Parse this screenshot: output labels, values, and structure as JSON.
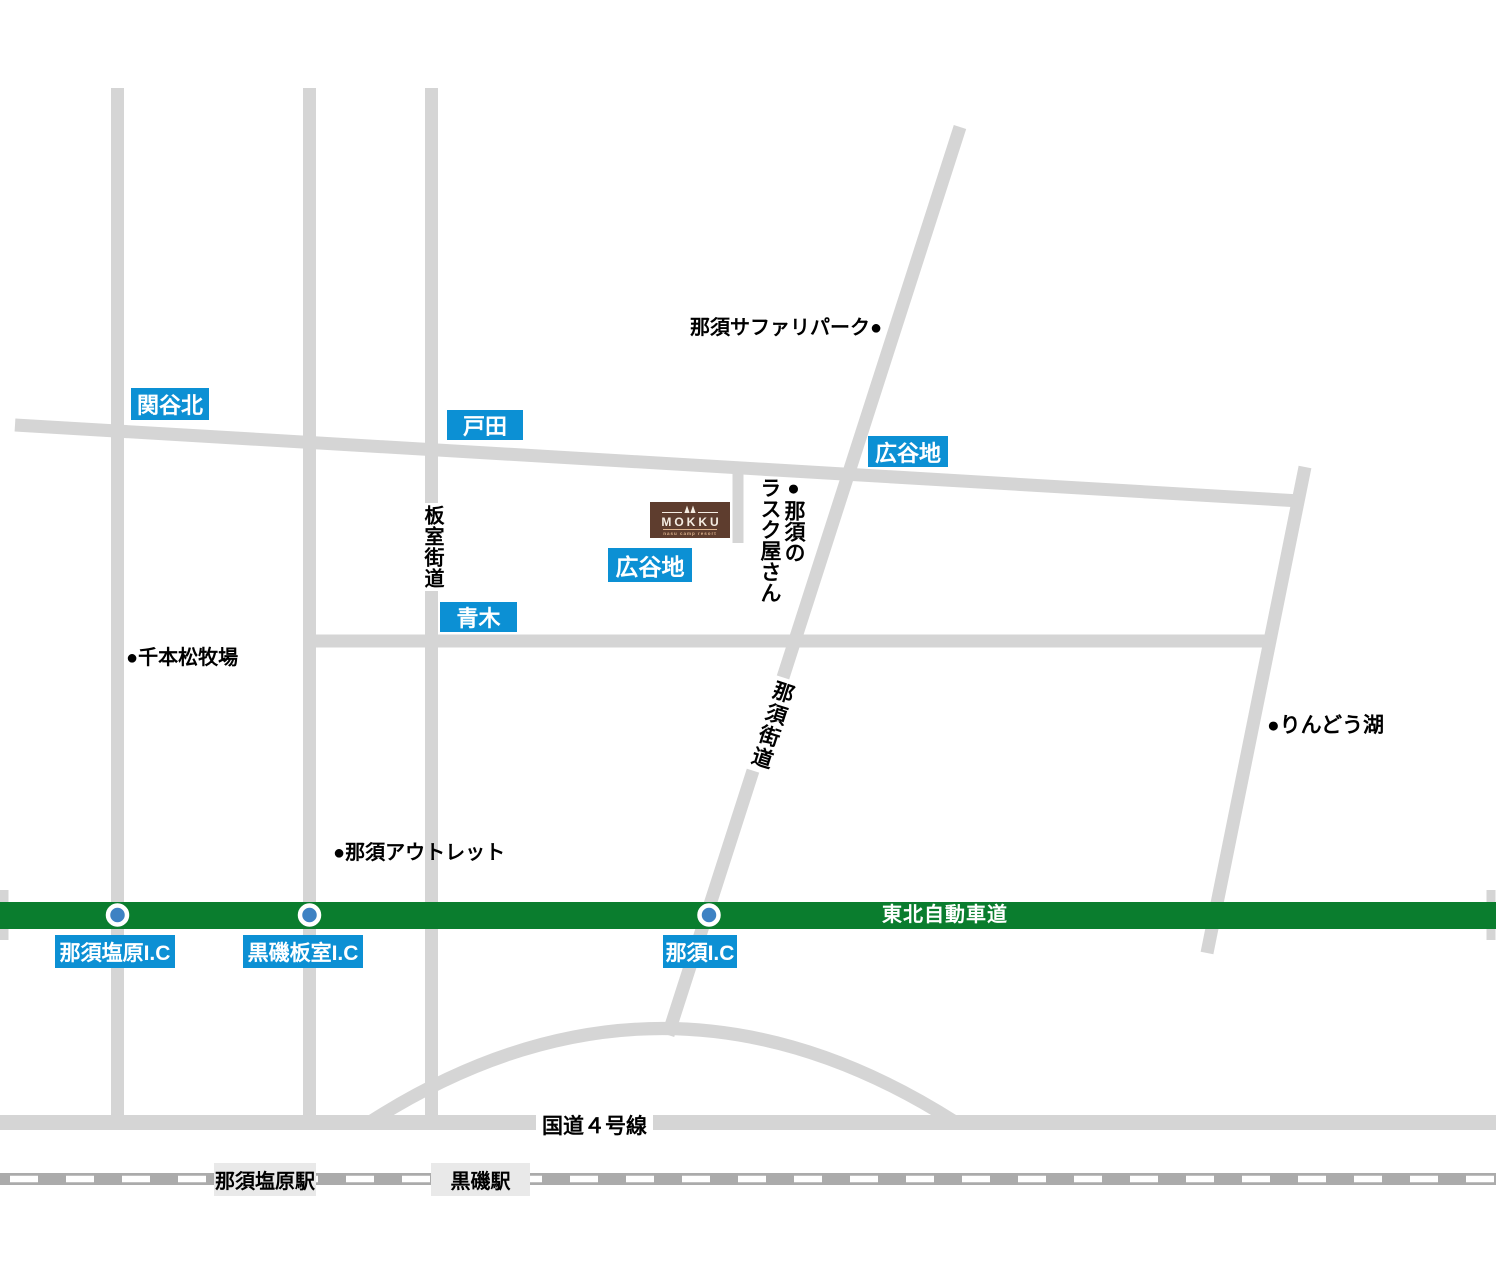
{
  "intersections": {
    "sekiyakita": "関谷北",
    "toda": "戸田",
    "hiroyachi_upper": "広谷地",
    "hiroyachi_lower": "広谷地",
    "aoki": "青木"
  },
  "interchanges": {
    "nasushiobara_ic": "那須塩原I.C",
    "kuroiso_itamuro_ic": "黒磯板室I.C",
    "nasu_ic": "那須I.C"
  },
  "roads": {
    "expressway": "東北自動車道",
    "route4": "国道４号線",
    "itamuro_kaido": "板室街道",
    "nasu_kaido": "那須街道"
  },
  "landmarks": {
    "safari_park": "那須サファリパーク●",
    "rusk_shop_col_right": "●那須の",
    "rusk_shop_col_left": "ラスク屋さん",
    "senbonmatsu_farm": "●千本松牧場",
    "nasu_outlet": "●那須アウトレット",
    "rindo_lake": "●りんどう湖"
  },
  "stations": {
    "nasushiobara_station": "那須塩原駅",
    "kuroiso_station": "黒磯駅"
  },
  "logo": {
    "name": "MOKKU",
    "subtitle": "nasu camp resort"
  },
  "colors": {
    "road": "#d5d5d5",
    "expressway_green": "#0a7d2e",
    "label_blue": "#0c90d4",
    "ic_circle_blue": "#3e82c3",
    "logo_brown": "#5e3d2e",
    "railway_gray": "#ababab",
    "station_bg": "#e9e9e9"
  }
}
